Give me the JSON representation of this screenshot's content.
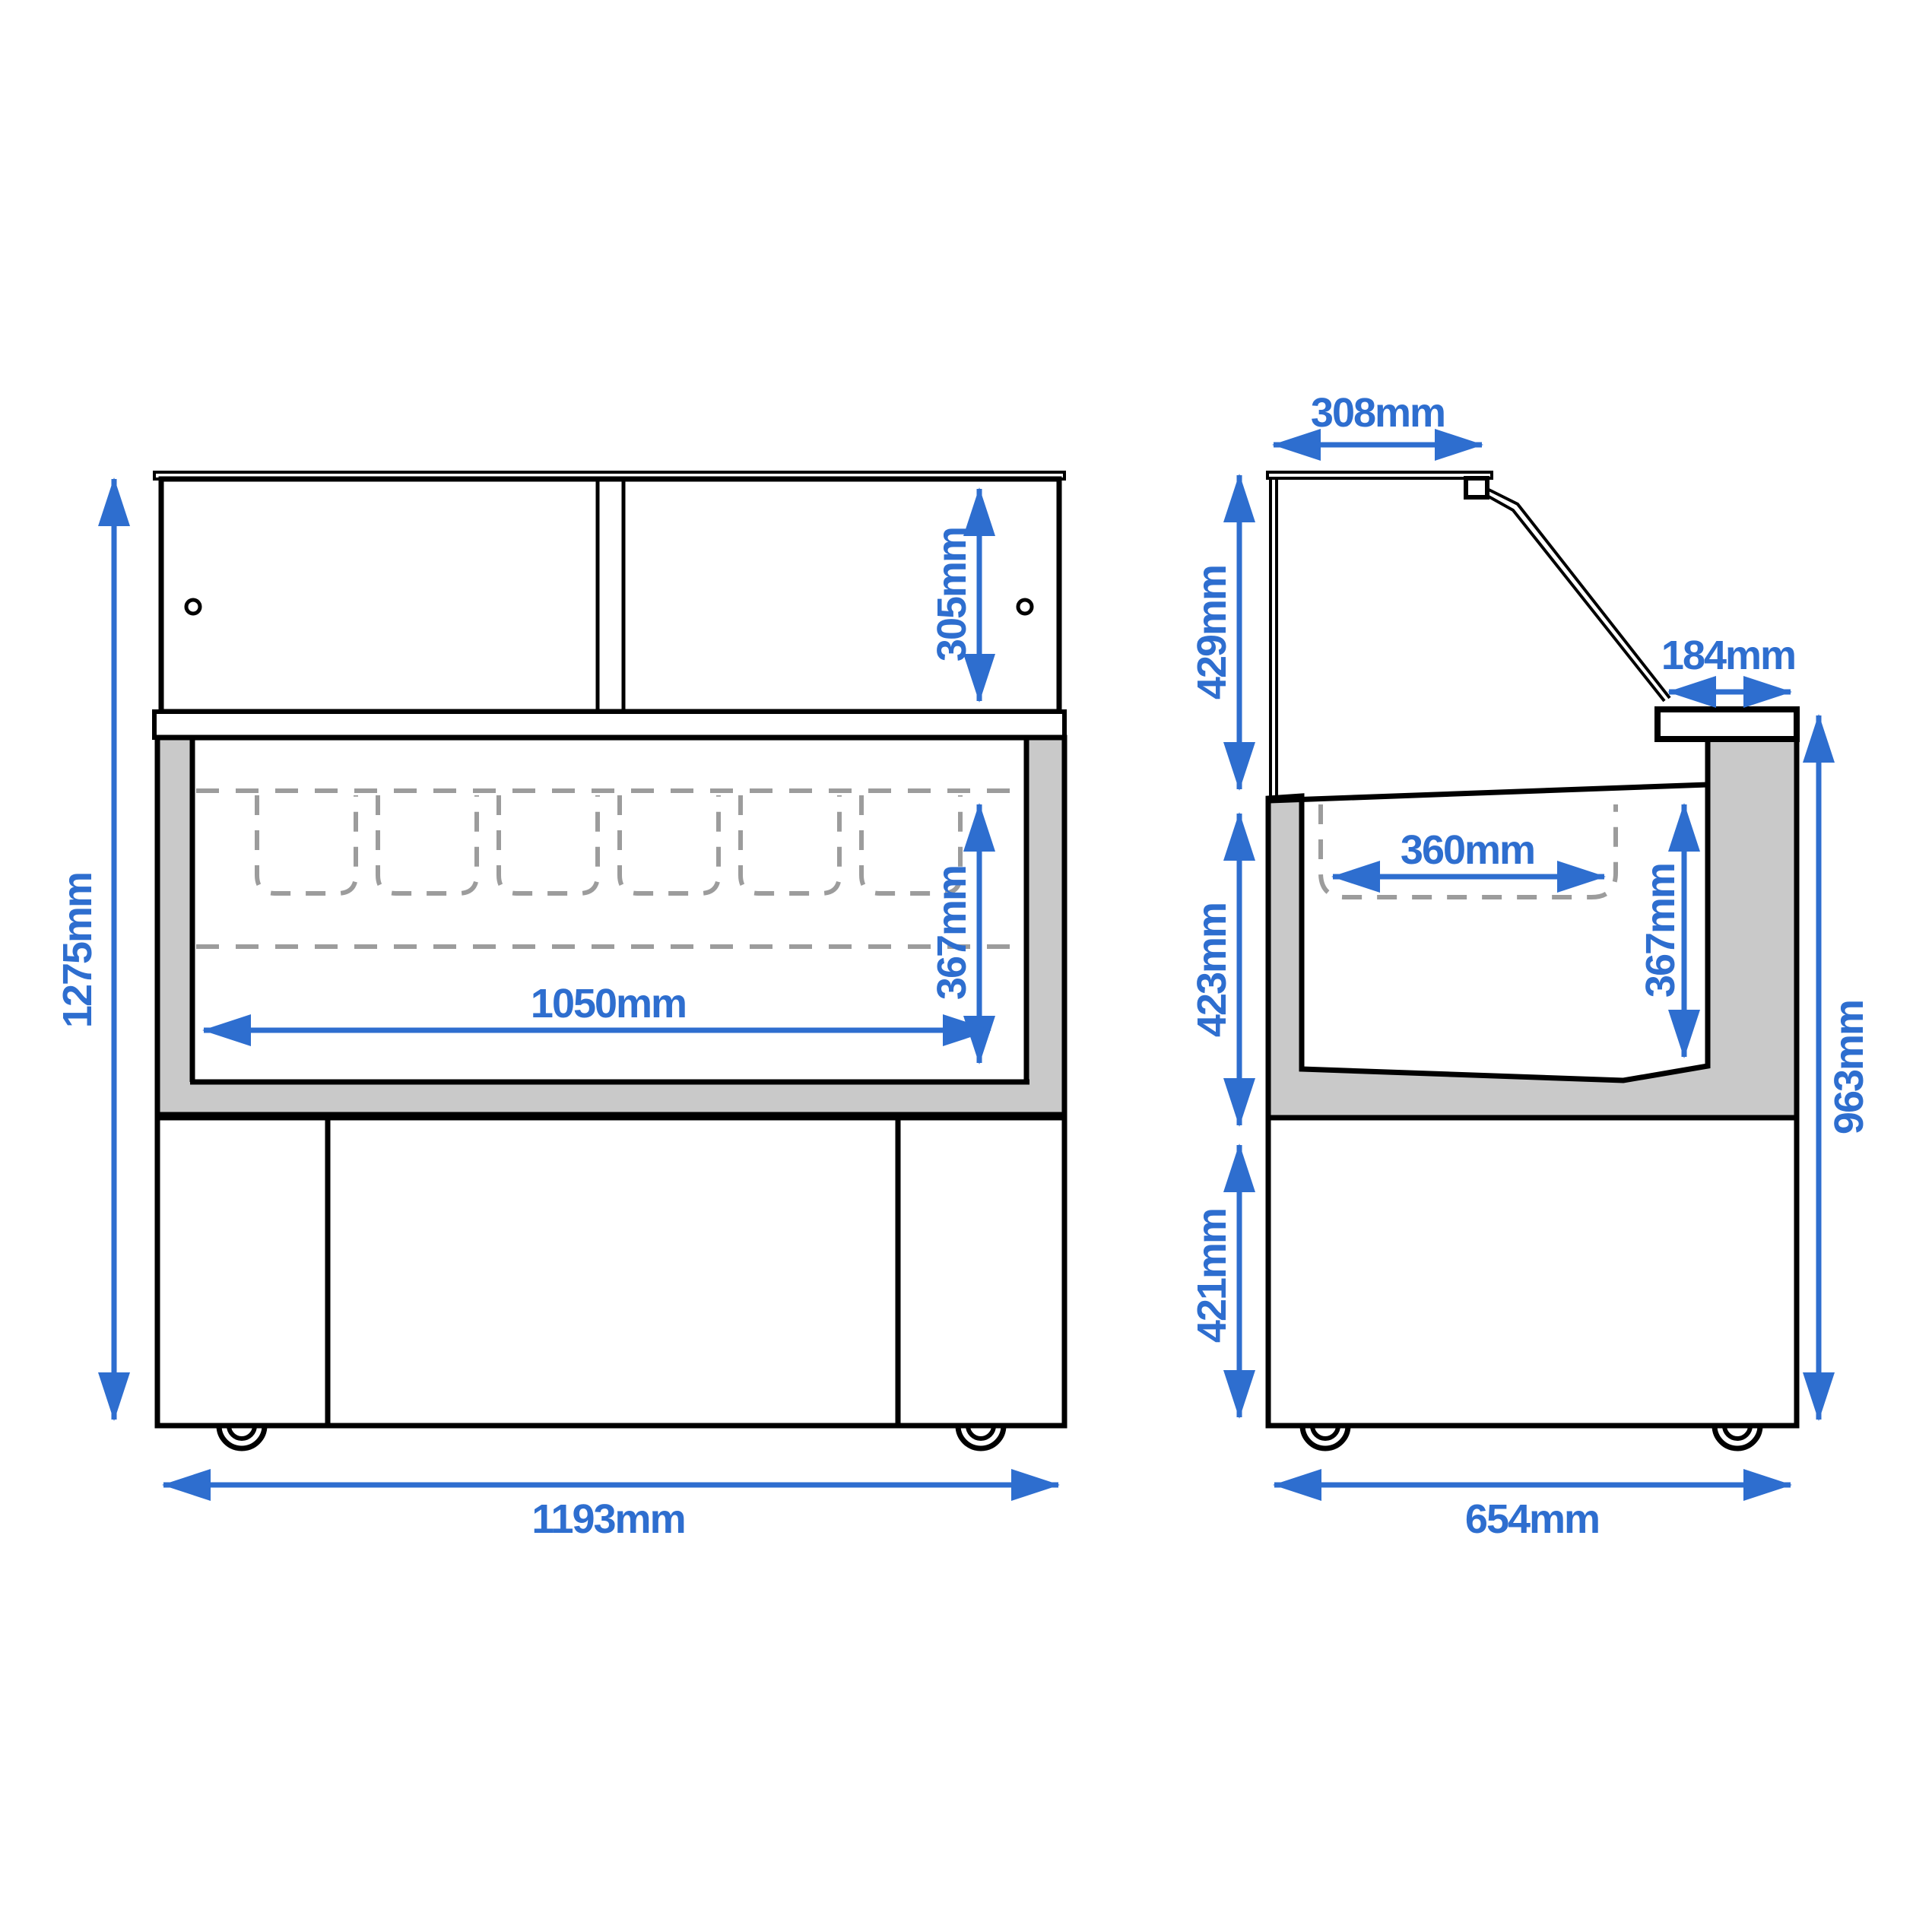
{
  "drawing_type": "refrigerated-display-counter-dimension-drawing",
  "dimensions": {
    "front_overall_height": "1275mm",
    "front_hutch_height": "305mm",
    "front_pan_depth": "367mm",
    "front_pan_row_width": "1050mm",
    "front_overall_width": "1193mm",
    "side_top_depth": "308mm",
    "side_upper_section_height": "429mm",
    "side_board_depth": "184mm",
    "side_mid_section_height": "423mm",
    "side_pan_width": "360mm",
    "side_pan_depth": "367mm",
    "side_base_height": "421mm",
    "side_counter_height": "963mm",
    "side_overall_depth": "654mm"
  },
  "colors": {
    "dimension_blue": "#2e6ecf",
    "panel_gray": "#c9c9c9",
    "dashed_gray": "#9c9c9c",
    "line_black": "#000000"
  }
}
